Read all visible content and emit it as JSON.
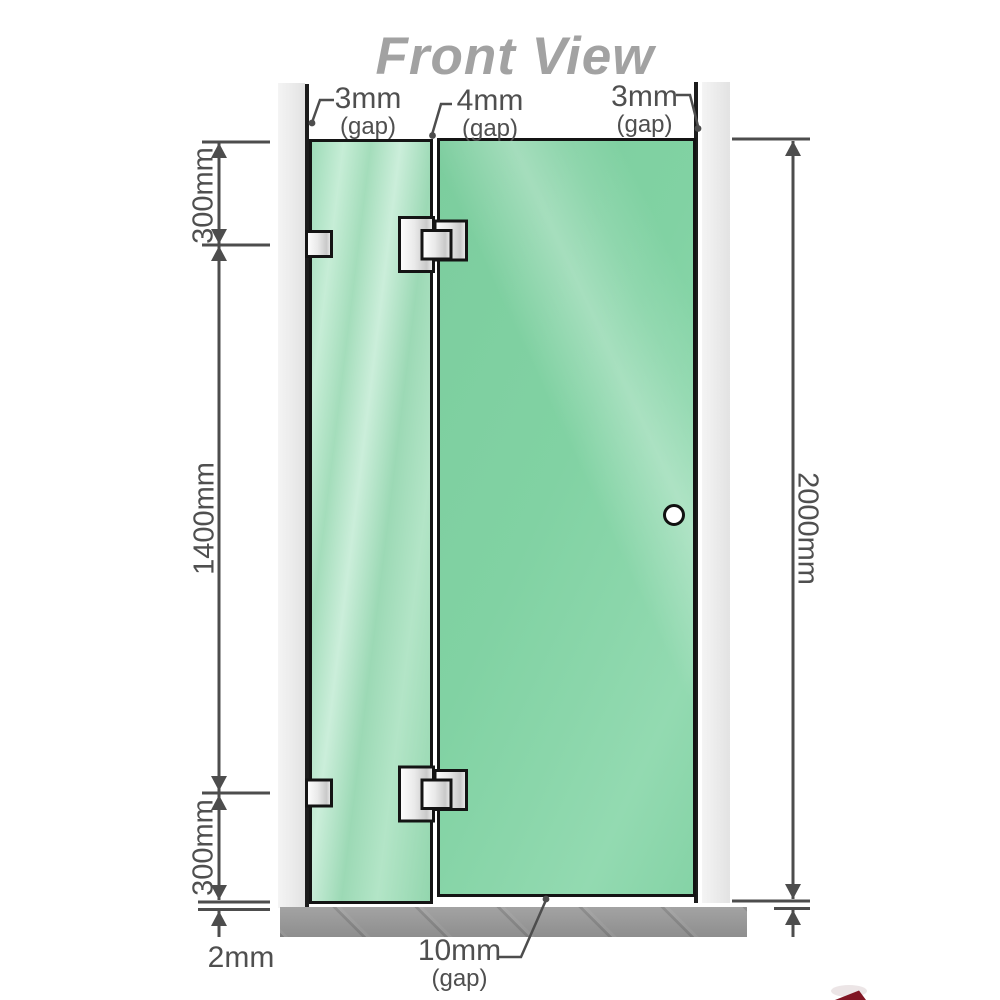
{
  "title": "Front View",
  "colors": {
    "glass_green": "#7fd0a1",
    "glass_green_light": "#a8e0c0",
    "wall_gray": "#ececec",
    "floor_gray": "#9a9a9a",
    "dimension_gray": "#4d4d4d",
    "title_gray": "#a2a2a2",
    "hardware_black": "#141414",
    "watermark_red": "#801523"
  },
  "gaps": {
    "top_left": {
      "value": "3mm",
      "label": "(gap)"
    },
    "top_middle": {
      "value": "4mm",
      "label": "(gap)"
    },
    "top_right": {
      "value": "3mm",
      "label": "(gap)"
    },
    "bottom": {
      "value": "10mm",
      "label": "(gap)"
    }
  },
  "dimensions": {
    "left_top": "300mm",
    "left_middle": "1400mm",
    "left_bottom": "300mm",
    "floor_gap": "2mm",
    "right_total": "2000mm"
  }
}
